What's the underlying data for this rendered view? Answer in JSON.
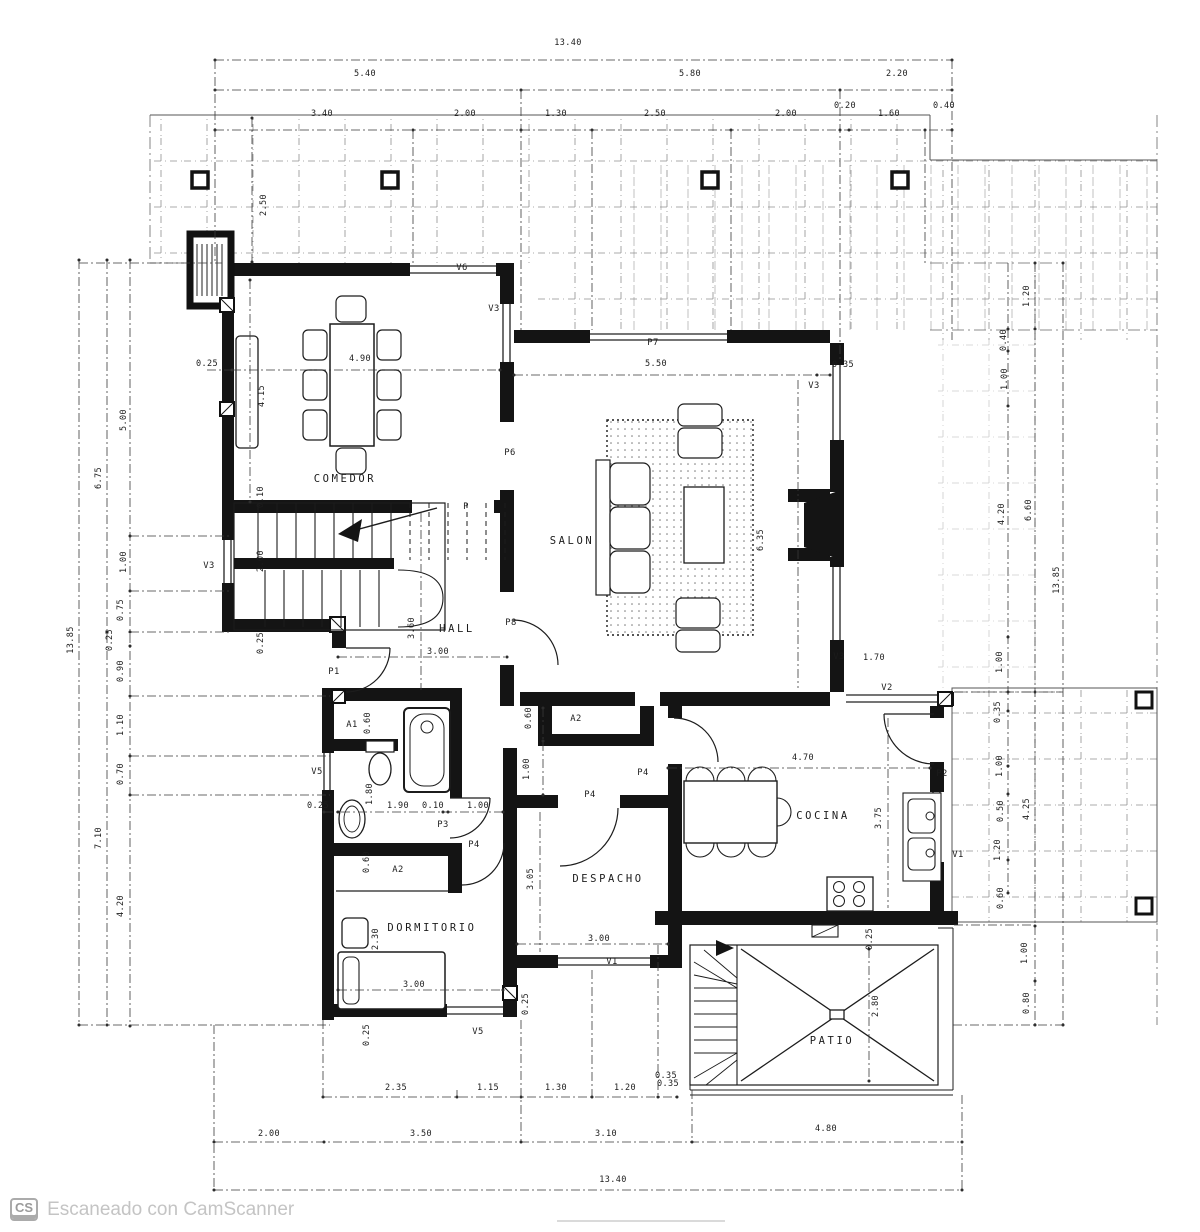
{
  "footer": {
    "badge": "CS",
    "text": "Escaneado con CamScanner"
  },
  "plan": {
    "rooms": [
      {
        "t": "COMEDOR",
        "x": 345,
        "y": 482
      },
      {
        "t": "SALON",
        "x": 572,
        "y": 544
      },
      {
        "t": "HALL",
        "x": 457,
        "y": 632
      },
      {
        "t": "DESPACHO",
        "x": 608,
        "y": 882
      },
      {
        "t": "DORMITORIO",
        "x": 432,
        "y": 931
      },
      {
        "t": "COCINA",
        "x": 823,
        "y": 819
      },
      {
        "t": "PATIO",
        "x": 832,
        "y": 1044
      }
    ],
    "tags": [
      {
        "t": "V6",
        "x": 462,
        "y": 270
      },
      {
        "t": "V3",
        "x": 494,
        "y": 311
      },
      {
        "t": "V3",
        "x": 209,
        "y": 568
      },
      {
        "t": "P7",
        "x": 653,
        "y": 345
      },
      {
        "t": "V3",
        "x": 814,
        "y": 388
      },
      {
        "t": "P6",
        "x": 510,
        "y": 455
      },
      {
        "t": "P",
        "x": 466,
        "y": 509
      },
      {
        "t": "P8",
        "x": 511,
        "y": 625
      },
      {
        "t": "V3",
        "x": 839,
        "y": 659
      },
      {
        "t": "V2",
        "x": 887,
        "y": 690
      },
      {
        "t": "P1",
        "x": 334,
        "y": 674
      },
      {
        "t": "A1",
        "x": 352,
        "y": 727
      },
      {
        "t": "V5",
        "x": 317,
        "y": 774
      },
      {
        "t": "P3",
        "x": 443,
        "y": 827
      },
      {
        "t": "A2",
        "x": 576,
        "y": 721
      },
      {
        "t": "P4",
        "x": 643,
        "y": 775
      },
      {
        "t": "P4",
        "x": 590,
        "y": 797
      },
      {
        "t": "P4",
        "x": 474,
        "y": 847
      },
      {
        "t": "P2",
        "x": 942,
        "y": 776
      },
      {
        "t": "V1",
        "x": 958,
        "y": 857
      },
      {
        "t": "V1",
        "x": 612,
        "y": 964
      },
      {
        "t": "A2",
        "x": 398,
        "y": 872
      },
      {
        "t": "V5",
        "x": 478,
        "y": 1034
      }
    ],
    "dimensions": [
      {
        "t": "13.40",
        "x": 568,
        "y": 45
      },
      {
        "t": "5.40",
        "x": 365,
        "y": 76
      },
      {
        "t": "5.80",
        "x": 690,
        "y": 76
      },
      {
        "t": "2.20",
        "x": 897,
        "y": 76
      },
      {
        "t": "3.40",
        "x": 322,
        "y": 116
      },
      {
        "t": "2.00",
        "x": 465,
        "y": 116
      },
      {
        "t": "1.30",
        "x": 556,
        "y": 116
      },
      {
        "t": "2.50",
        "x": 655,
        "y": 116
      },
      {
        "t": "2.00",
        "x": 786,
        "y": 116
      },
      {
        "t": "0.20",
        "x": 845,
        "y": 108,
        "s": 7
      },
      {
        "t": "1.60",
        "x": 889,
        "y": 116
      },
      {
        "t": "0.40",
        "x": 944,
        "y": 108,
        "s": 7
      },
      {
        "t": "13.85",
        "x": 73,
        "y": 640,
        "r": -90
      },
      {
        "t": "6.75",
        "x": 101,
        "y": 478,
        "r": -90
      },
      {
        "t": "7.10",
        "x": 101,
        "y": 838,
        "r": -90
      },
      {
        "t": "5.00",
        "x": 126,
        "y": 420,
        "r": -90
      },
      {
        "t": "1.00",
        "x": 126,
        "y": 562,
        "r": -90
      },
      {
        "t": "0.75",
        "x": 123,
        "y": 610,
        "r": -90
      },
      {
        "t": "0.25",
        "x": 112,
        "y": 640,
        "r": -90,
        "s": 7
      },
      {
        "t": "0.90",
        "x": 123,
        "y": 671,
        "r": -90
      },
      {
        "t": "1.10",
        "x": 123,
        "y": 725,
        "r": -90
      },
      {
        "t": "0.70",
        "x": 123,
        "y": 774,
        "r": -90
      },
      {
        "t": "4.20",
        "x": 123,
        "y": 906,
        "r": -90
      },
      {
        "t": "1.20",
        "x": 1029,
        "y": 296,
        "r": -90
      },
      {
        "t": "0.40",
        "x": 1006,
        "y": 340,
        "r": -90,
        "s": 7
      },
      {
        "t": "1.00",
        "x": 1007,
        "y": 379,
        "r": -90
      },
      {
        "t": "4.20",
        "x": 1004,
        "y": 514,
        "r": -90
      },
      {
        "t": "6.60",
        "x": 1031,
        "y": 510,
        "r": -90
      },
      {
        "t": "13.85",
        "x": 1059,
        "y": 580,
        "r": -90
      },
      {
        "t": "1.00",
        "x": 1002,
        "y": 662,
        "r": -90
      },
      {
        "t": "0.35",
        "x": 1000,
        "y": 712,
        "r": -90,
        "s": 7
      },
      {
        "t": "1.00",
        "x": 1002,
        "y": 766,
        "r": -90
      },
      {
        "t": "0.50",
        "x": 1003,
        "y": 811,
        "r": -90,
        "s": 7
      },
      {
        "t": "4.25",
        "x": 1029,
        "y": 809,
        "r": -90
      },
      {
        "t": "1.20",
        "x": 1000,
        "y": 850,
        "r": -90
      },
      {
        "t": "0.60",
        "x": 1003,
        "y": 898,
        "r": -90,
        "s": 7
      },
      {
        "t": "1.00",
        "x": 1027,
        "y": 953,
        "r": -90
      },
      {
        "t": "0.80",
        "x": 1029,
        "y": 1003,
        "r": -90
      },
      {
        "t": "2.35",
        "x": 396,
        "y": 1090
      },
      {
        "t": "1.15",
        "x": 488,
        "y": 1090
      },
      {
        "t": "1.30",
        "x": 556,
        "y": 1090
      },
      {
        "t": "1.20",
        "x": 625,
        "y": 1090
      },
      {
        "t": "0.35",
        "x": 668,
        "y": 1086,
        "s": 7
      },
      {
        "t": "2.00",
        "x": 269,
        "y": 1136
      },
      {
        "t": "3.50",
        "x": 421,
        "y": 1136
      },
      {
        "t": "3.10",
        "x": 606,
        "y": 1136
      },
      {
        "t": "4.80",
        "x": 826,
        "y": 1131
      },
      {
        "t": "13.40",
        "x": 613,
        "y": 1182
      },
      {
        "t": "2.50",
        "x": 266,
        "y": 205,
        "r": -90
      },
      {
        "t": "0.25",
        "x": 207,
        "y": 366,
        "s": 7
      },
      {
        "t": "4.90",
        "x": 360,
        "y": 361
      },
      {
        "t": "4.15",
        "x": 264,
        "y": 396,
        "r": -90
      },
      {
        "t": "5.50",
        "x": 656,
        "y": 366
      },
      {
        "t": "0.35",
        "x": 843,
        "y": 367,
        "s": 7
      },
      {
        "t": "6.35",
        "x": 763,
        "y": 540,
        "r": -90
      },
      {
        "t": "1.70",
        "x": 874,
        "y": 660
      },
      {
        "t": "3.60",
        "x": 414,
        "y": 628,
        "r": -90
      },
      {
        "t": "3.00",
        "x": 438,
        "y": 654
      },
      {
        "t": "2.00",
        "x": 263,
        "y": 561,
        "r": -90
      },
      {
        "t": "0.10",
        "x": 263,
        "y": 497,
        "r": -90,
        "s": 7
      },
      {
        "t": "0.25",
        "x": 263,
        "y": 643,
        "r": -90,
        "s": 7
      },
      {
        "t": "0.60",
        "x": 370,
        "y": 723,
        "r": -90,
        "s": 7
      },
      {
        "t": "1.80",
        "x": 372,
        "y": 794,
        "r": -90
      },
      {
        "t": "1.90",
        "x": 398,
        "y": 808
      },
      {
        "t": "0.10",
        "x": 433,
        "y": 808,
        "s": 7
      },
      {
        "t": "1.00",
        "x": 478,
        "y": 808
      },
      {
        "t": "0.25",
        "x": 318,
        "y": 808,
        "s": 7
      },
      {
        "t": "0.60",
        "x": 531,
        "y": 718,
        "r": -90,
        "s": 7
      },
      {
        "t": "1.00",
        "x": 529,
        "y": 769,
        "r": -90
      },
      {
        "t": "0.60",
        "x": 369,
        "y": 862,
        "r": -90,
        "s": 7
      },
      {
        "t": "2.30",
        "x": 378,
        "y": 939,
        "r": -90
      },
      {
        "t": "3.00",
        "x": 414,
        "y": 987
      },
      {
        "t": "0.25",
        "x": 369,
        "y": 1035,
        "r": -90,
        "s": 7
      },
      {
        "t": "0.25",
        "x": 528,
        "y": 1004,
        "r": -90,
        "s": 7
      },
      {
        "t": "3.05",
        "x": 533,
        "y": 879,
        "r": -90
      },
      {
        "t": "3.00",
        "x": 599,
        "y": 941
      },
      {
        "t": "4.70",
        "x": 803,
        "y": 760
      },
      {
        "t": "3.75",
        "x": 881,
        "y": 818,
        "r": -90
      },
      {
        "t": "0.25",
        "x": 872,
        "y": 939,
        "r": -90,
        "s": 7
      },
      {
        "t": "2.80",
        "x": 878,
        "y": 1006,
        "r": -90
      },
      {
        "t": "0.35",
        "x": 666,
        "y": 1078,
        "s": 7
      }
    ]
  }
}
